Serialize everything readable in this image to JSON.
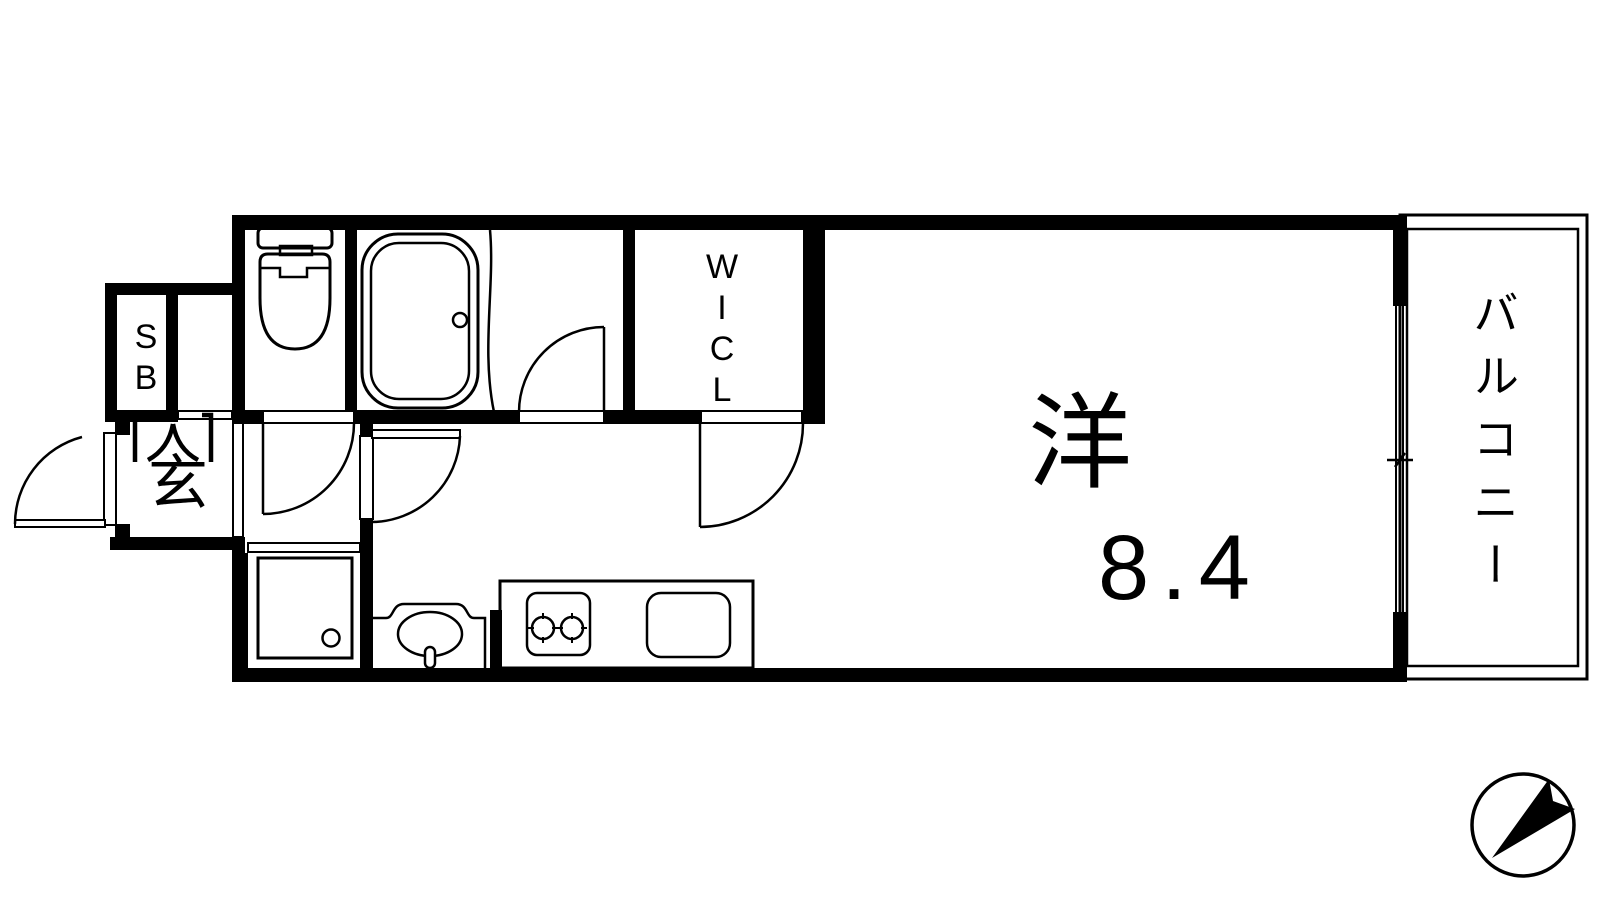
{
  "plan": {
    "type": "apartment-floor-plan",
    "labels": {
      "main_room_name": "洋",
      "main_room_size": "8.4",
      "balcony": "バルコニー",
      "walk_in_closet": "WICL",
      "entrance": "玄",
      "shoe_box": "SB"
    },
    "colors": {
      "line": "#000000",
      "background": "#ffffff"
    }
  }
}
